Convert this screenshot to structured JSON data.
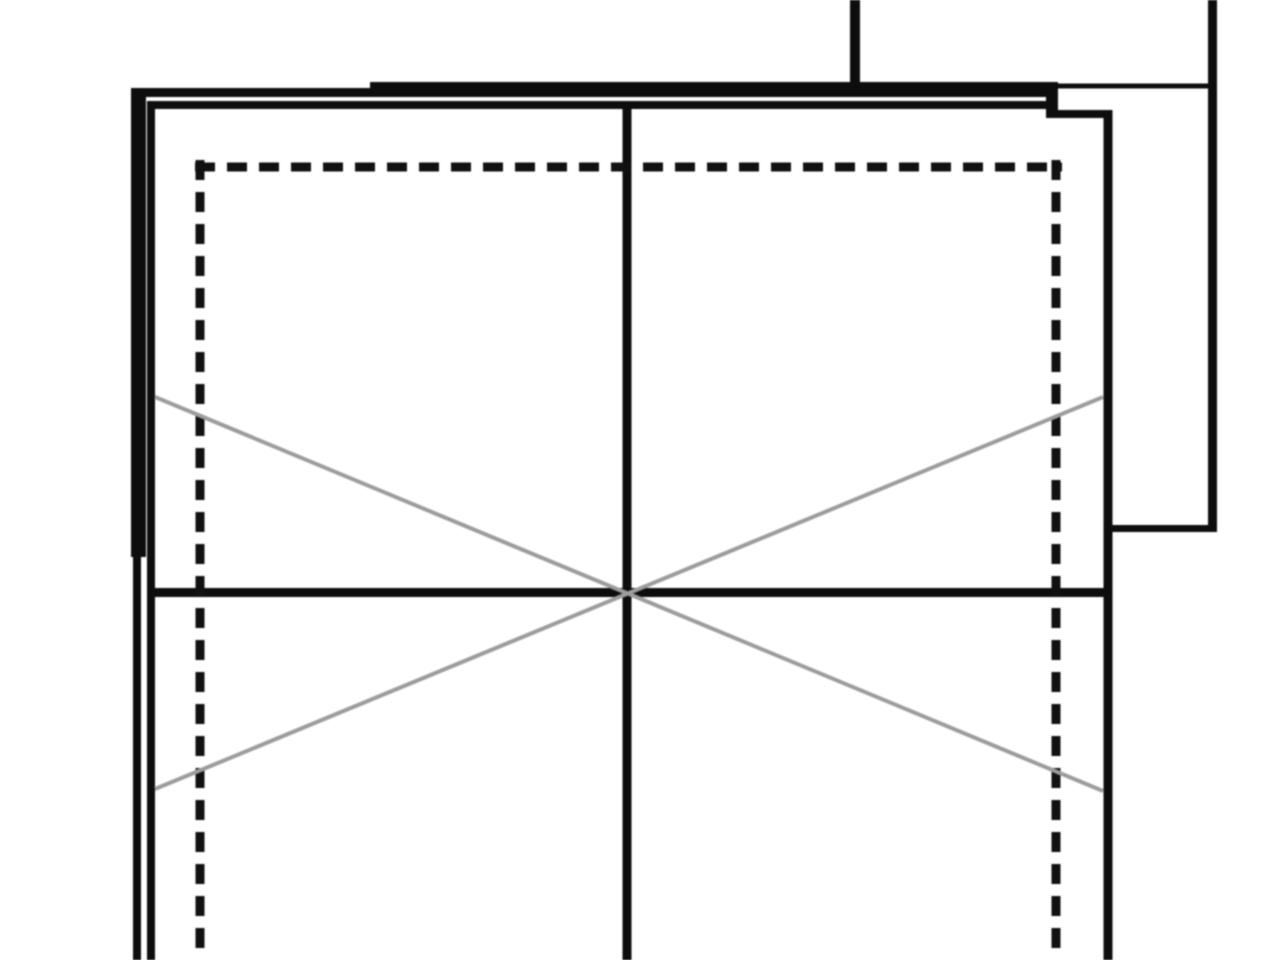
{
  "meta": {
    "description": "Zoomed-in monochrome architectural floor plan (CAD drawing) fragment with double-line walls, dashed roof outline and gray cross-bracing X symbol",
    "visible_text": []
  },
  "colors": {
    "background": "#ffffff",
    "line": "#0d0d0d",
    "dashed": "#111111",
    "diagonal": "#9c9c9c"
  },
  "drawing": {
    "width": 1280,
    "height": 960,
    "dash_pattern": "20 12",
    "segments": [
      {
        "name": "top-wall-left-outer-line",
        "color": "line",
        "x1": 131,
        "y1": 92.5,
        "x2": 372,
        "y2": 92.5,
        "w": 9,
        "crisp": true
      },
      {
        "name": "top-wall-main-outer-line",
        "color": "line",
        "x1": 370,
        "y1": 89.5,
        "x2": 1058,
        "y2": 89.5,
        "w": 15,
        "crisp": true
      },
      {
        "name": "top-wall-inner-face-line",
        "color": "line",
        "x1": 147,
        "y1": 105,
        "x2": 1046,
        "y2": 105,
        "w": 8,
        "crisp": true
      },
      {
        "name": "top-wall-end-cap",
        "color": "line",
        "x1": 1052,
        "y1": 82,
        "x2": 1052,
        "y2": 118,
        "w": 12,
        "crisp": true
      },
      {
        "name": "top-right-step-line",
        "color": "line",
        "x1": 1054,
        "y1": 114,
        "x2": 1110,
        "y2": 114,
        "w": 8,
        "crisp": true
      },
      {
        "name": "roof-edge-right-thin-line",
        "color": "line",
        "x1": 1055,
        "y1": 86,
        "x2": 1217,
        "y2": 86,
        "w": 5,
        "crisp": true
      },
      {
        "name": "upper-stub-line",
        "color": "line",
        "x1": 855,
        "y1": 0,
        "x2": 855,
        "y2": 90,
        "w": 10,
        "crisp": true
      },
      {
        "name": "right-boundary-line",
        "color": "line",
        "x1": 1212.5,
        "y1": 0,
        "x2": 1212.5,
        "y2": 531,
        "w": 9,
        "crisp": true
      },
      {
        "name": "right-structure-bottom-line",
        "color": "line",
        "x1": 1104,
        "y1": 528.5,
        "x2": 1217,
        "y2": 528.5,
        "w": 7,
        "crisp": true
      },
      {
        "name": "right-wall-line",
        "color": "line",
        "x1": 1108,
        "y1": 110,
        "x2": 1108,
        "y2": 960,
        "w": 9,
        "crisp": true
      },
      {
        "name": "left-wall-thick-upper-line",
        "color": "line",
        "x1": 138.5,
        "y1": 88,
        "x2": 138.5,
        "y2": 557,
        "w": 15,
        "crisp": true
      },
      {
        "name": "left-wall-outer-lower-line",
        "color": "line",
        "x1": 137,
        "y1": 555,
        "x2": 137,
        "y2": 960,
        "w": 8,
        "crisp": true
      },
      {
        "name": "left-wall-inner-line",
        "color": "line",
        "x1": 151,
        "y1": 101,
        "x2": 151,
        "y2": 960,
        "w": 8,
        "crisp": true
      },
      {
        "name": "center-partition-line",
        "color": "line",
        "x1": 627,
        "y1": 107,
        "x2": 627,
        "y2": 960,
        "w": 9,
        "crisp": true
      },
      {
        "name": "mid-wall-line",
        "color": "line",
        "x1": 150,
        "y1": 592.5,
        "x2": 1108,
        "y2": 592.5,
        "w": 9,
        "crisp": true
      },
      {
        "name": "dashed-outline-top",
        "color": "dashed",
        "x1": 195,
        "y1": 167,
        "x2": 1062,
        "y2": 167,
        "w": 9,
        "crisp": true,
        "dashed": true
      },
      {
        "name": "dashed-outline-left",
        "color": "dashed",
        "x1": 200,
        "y1": 160,
        "x2": 200,
        "y2": 960,
        "w": 9,
        "crisp": true,
        "dashed": true
      },
      {
        "name": "dashed-outline-right",
        "color": "dashed",
        "x1": 1056,
        "y1": 160,
        "x2": 1056,
        "y2": 960,
        "w": 9,
        "crisp": true,
        "dashed": true
      },
      {
        "name": "cross-brace-diagonal-a",
        "color": "diagonal",
        "x1": 155,
        "y1": 397,
        "x2": 1103,
        "y2": 791,
        "w": 4,
        "crisp": false
      },
      {
        "name": "cross-brace-diagonal-b",
        "color": "diagonal",
        "x1": 155,
        "y1": 789,
        "x2": 1103,
        "y2": 397,
        "w": 4,
        "crisp": false
      }
    ]
  }
}
